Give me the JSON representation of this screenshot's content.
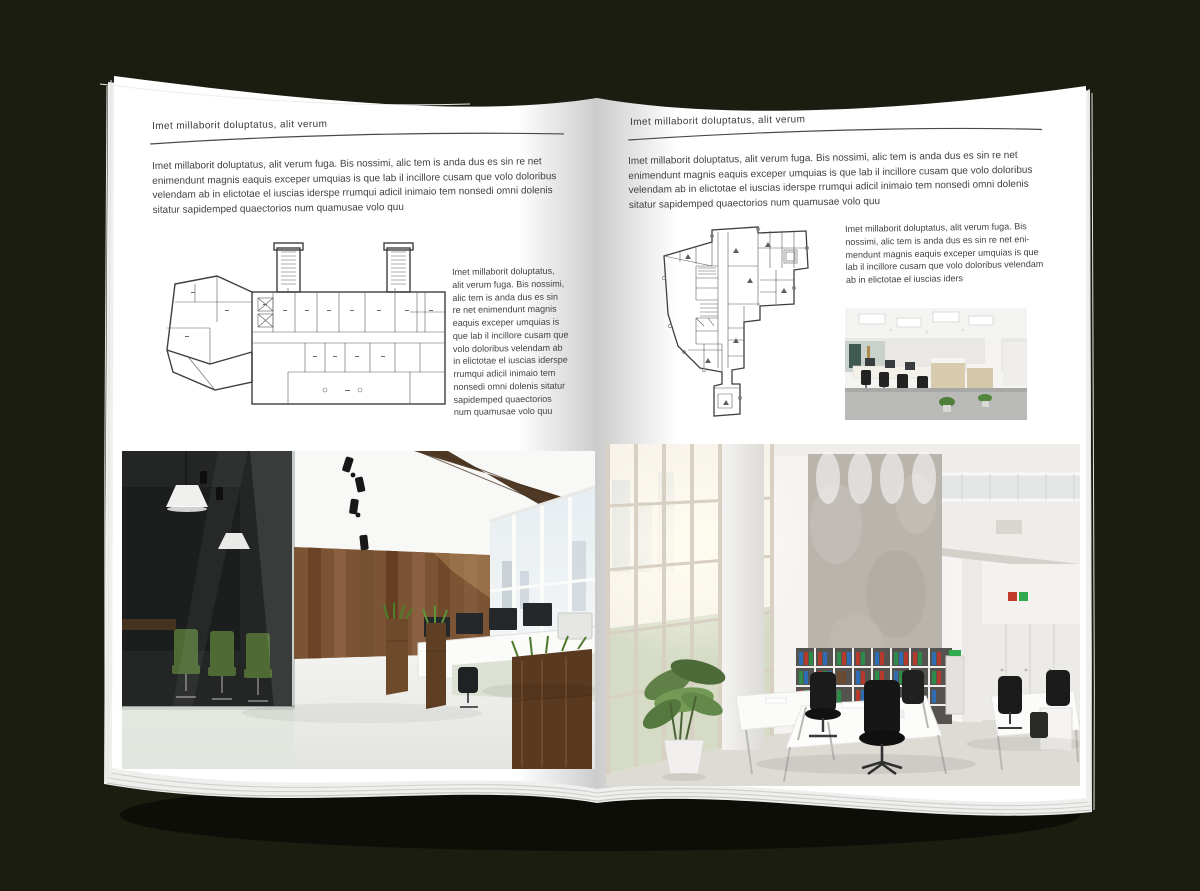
{
  "document_type": "magazine-spread-mockup",
  "colors": {
    "backdrop": "#1c1d11",
    "paper": "#ffffff",
    "text": "#3d3d3d",
    "rule": "#4a4a4a",
    "plan_ink": "#3f3f3f",
    "wood_wall": "#7b5433",
    "wood_planter": "#6e4a2b",
    "chair_green": "#4f6a35",
    "chair_black": "#161616",
    "binder_red": "#b43a2e",
    "binder_green": "#2e8b4a",
    "binder_blue": "#2e6db4",
    "window_glass": "#dfe7ec",
    "concrete": "#b9b5ad"
  },
  "left_page": {
    "header": "Imet millaborit doluptatus, alit verum",
    "intro": "Imet millaborit doluptatus, alit verum fuga. Bis nossimi, alic tem is anda dus es sin re net enimendunt magnis eaquis exceper umquias is que lab il incillore cusam que volo doloribus velendam ab in elictotae el iuscias iderspe rrumqui adicil inimaio tem nonsedi omni dolenis sitatur sapidemped quaectorios num quamusae volo quu",
    "caption": "Imet millaborit doluptatus, alit verum fuga. Bis nossimi, alic tem is anda dus es sin re net enimendunt magnis eaquis exceper umquias is que lab il incillore cusam que volo doloribus velendam ab in elictotae el iuscias iderspe rrumqui adicil inimaio tem nonsedi omni dolenis sitatur sapidemped quaectorios num quamusae volo quu",
    "floor_plan": "rectangular-office-building-plan-with-two-stair-towers-and-angled-west-wing",
    "photo": "loft-office-interior-glass-meeting-room-wood-wall"
  },
  "right_page": {
    "header": "Imet millaborit doluptatus, alit verum",
    "intro": "Imet millaborit doluptatus, alit verum fuga. Bis nossimi, alic tem is anda dus es sin re net enimendunt magnis eaquis exceper umquias is que lab il incillore cusam que volo doloribus velendam ab in elictotae el iuscias iderspe rrumqui adicil inimaio tem nonsedi omni dolenis sitatur sapidemped quaectorios num quamusae volo quu",
    "caption": "Imet millaborit doluptatus, alit verum fuga. Bis nossimi, alic tem is anda dus es sin re net eni-mendunt magnis eaquis exceper umquias is que lab il incillore cusam que volo doloribus velendam ab in elictotae el iuscias iders",
    "floor_plan": "irregular-triangular-office-building-plan-with-central-core",
    "photo_small": "open-plan-office-rows-of-desks-wood-cabinets",
    "photo_large": "double-height-white-office-atrium-concrete-wall-binder-shelves"
  }
}
